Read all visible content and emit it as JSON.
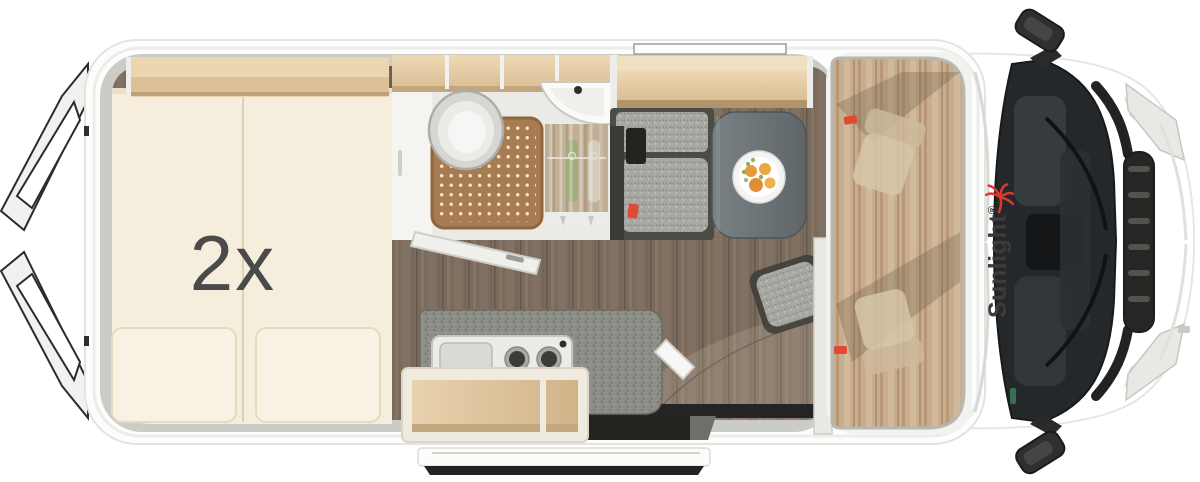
{
  "scene": {
    "description": "top-view floor plan of a camper van",
    "bed_label": "2x",
    "brand": {
      "name": "Sunlight",
      "mark": "®"
    }
  },
  "icons": {
    "palm": "palm-tree-icon"
  },
  "colors": {
    "background": "#ffffff",
    "body_white": "#fdfdfc",
    "rim_gray": "#cbcbc7",
    "bed_cream": "#f6eedd",
    "pillow_cream": "#f9f2e4",
    "bed_label_gray": "#4a4a4a",
    "wood_light": "#e6cda7",
    "wood_mid": "#d9bd94",
    "floor_brown": "#7b6b5d",
    "shower_brown": "#a87c53",
    "counter_gray": "#8e8e88",
    "bench_gray": "#a8a8a2",
    "table_gray": "#6d7477",
    "glass_dark": "#25282b",
    "logo_text": "#3b3b3b",
    "brand_red": "#d93a2b",
    "accent_red": "#e04a33"
  }
}
